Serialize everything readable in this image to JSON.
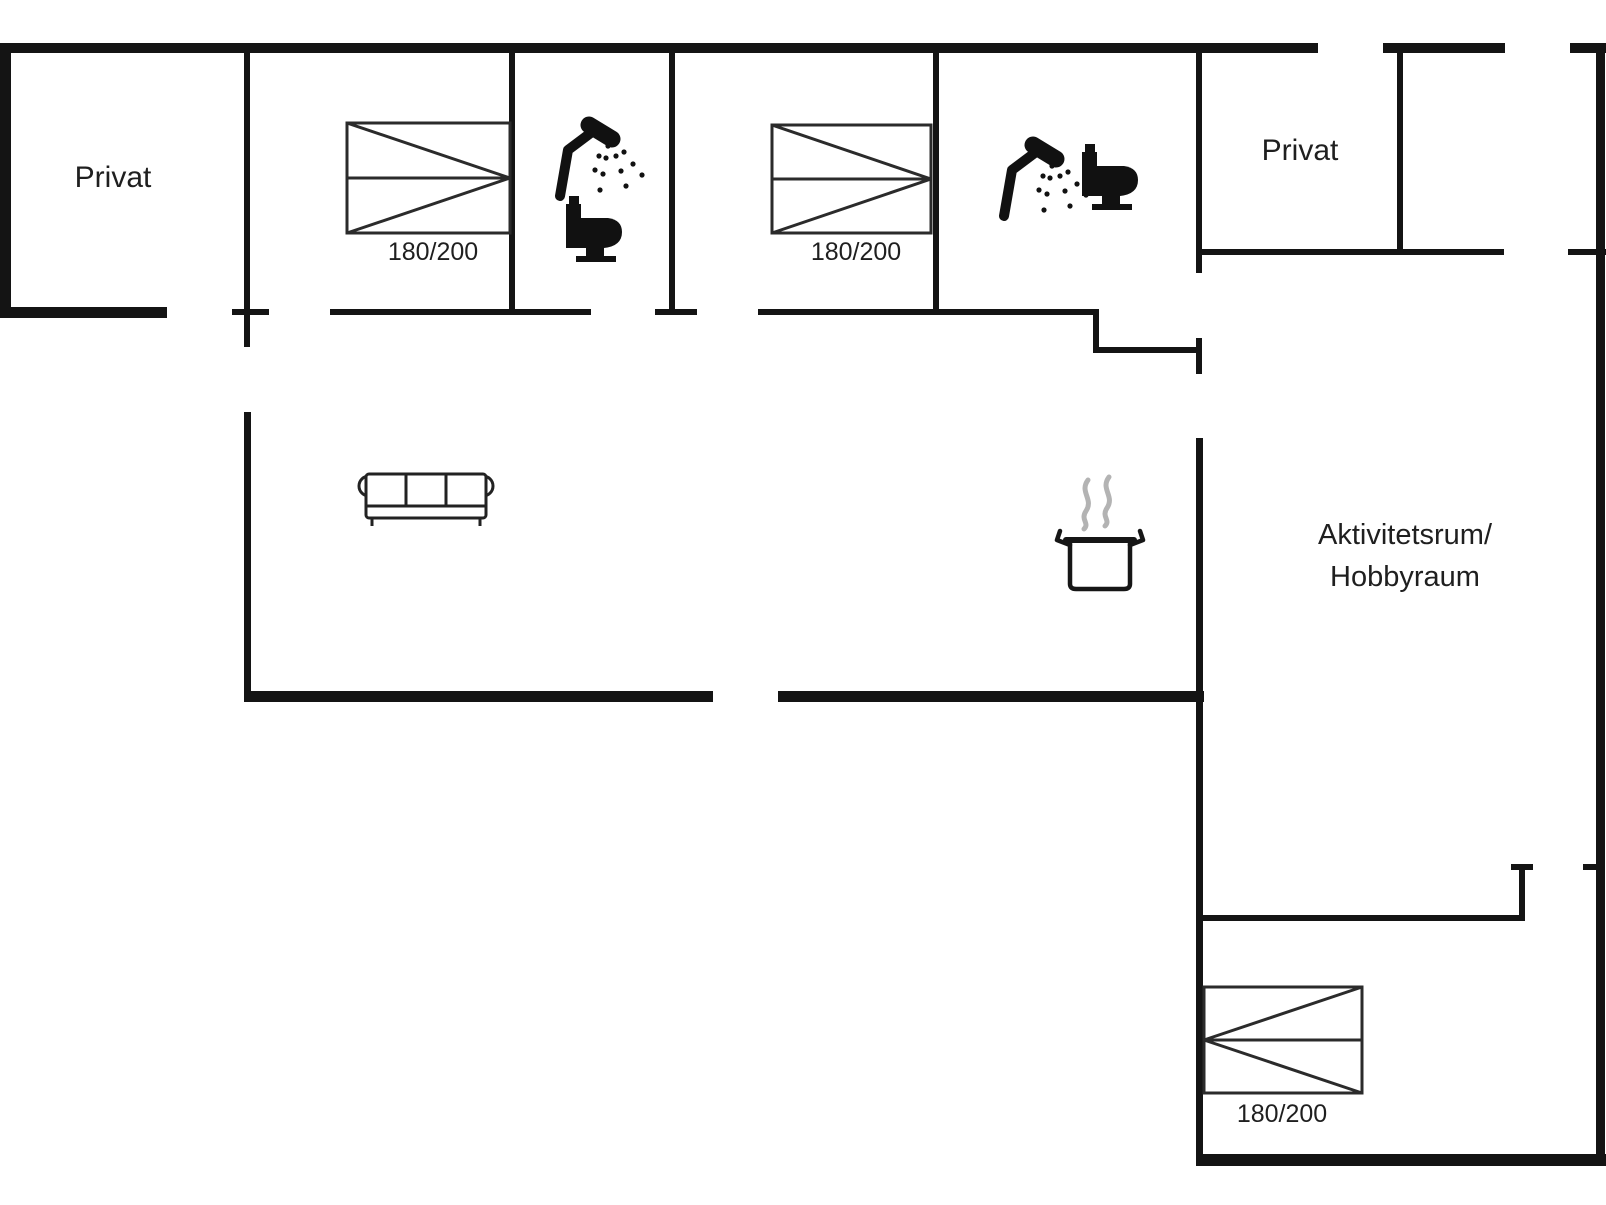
{
  "title": "Floor plan",
  "labels": {
    "privat_left": "Privat",
    "privat_right": "Privat",
    "activity_line1": "Aktivitetsrum/",
    "activity_line2": "Hobbyraum",
    "bed1_size": "180/200",
    "bed2_size": "180/200",
    "bed3_size": "180/200"
  },
  "colors": {
    "background": "#ffffff",
    "wall": "#141414",
    "furniture_line": "#222222",
    "steam": "#b3b3b3",
    "text": "#1f1f1f"
  },
  "floorplan": {
    "canvas": {
      "width": 1606,
      "height": 1205
    },
    "walls": [
      {
        "name": "top-wall-main",
        "x": 0,
        "y": 43,
        "w": 1318,
        "h": 10
      },
      {
        "name": "top-wall-seg2",
        "x": 1383,
        "y": 43,
        "w": 122,
        "h": 10
      },
      {
        "name": "top-wall-seg3",
        "x": 1570,
        "y": 43,
        "w": 36,
        "h": 10
      },
      {
        "name": "left-outer-wall",
        "x": 0,
        "y": 43,
        "w": 11,
        "h": 275
      },
      {
        "name": "privat-left-bottom-wall",
        "x": 0,
        "y": 307,
        "w": 167,
        "h": 11
      },
      {
        "name": "living-bottom-wall-left",
        "x": 244,
        "y": 691,
        "w": 469,
        "h": 11
      },
      {
        "name": "living-bottom-wall-right",
        "x": 778,
        "y": 691,
        "w": 426,
        "h": 11
      },
      {
        "name": "wing-bottom-wall",
        "x": 1196,
        "y": 1154,
        "w": 410,
        "h": 12
      },
      {
        "name": "right-outer-wall",
        "x": 1596,
        "y": 47,
        "w": 9,
        "h": 1113
      },
      {
        "name": "divider-privat1-bed1",
        "x": 244,
        "y": 43,
        "w": 6,
        "h": 304
      },
      {
        "name": "door-cap-247",
        "x": 232,
        "y": 309,
        "w": 37,
        "h": 6
      },
      {
        "name": "band-bottom-seg1",
        "x": 330,
        "y": 309,
        "w": 261,
        "h": 6
      },
      {
        "name": "divider-bed1-bath1",
        "x": 509,
        "y": 43,
        "w": 6,
        "h": 272
      },
      {
        "name": "divider-bath1-bed2",
        "x": 669,
        "y": 43,
        "w": 6,
        "h": 272
      },
      {
        "name": "door-cap-672",
        "x": 655,
        "y": 309,
        "w": 42,
        "h": 6
      },
      {
        "name": "band-bottom-seg2",
        "x": 758,
        "y": 309,
        "w": 340,
        "h": 6
      },
      {
        "name": "divider-bed2-bath2",
        "x": 933,
        "y": 43,
        "w": 6,
        "h": 272
      },
      {
        "name": "step-wall-vertical",
        "x": 1093,
        "y": 309,
        "w": 6,
        "h": 43
      },
      {
        "name": "step-wall-horizontal",
        "x": 1093,
        "y": 347,
        "w": 107,
        "h": 6
      },
      {
        "name": "door-cap-1198",
        "x": 1196,
        "y": 338,
        "w": 6,
        "h": 36
      },
      {
        "name": "privat-right-left-wall",
        "x": 1196,
        "y": 43,
        "w": 6,
        "h": 230
      },
      {
        "name": "activity-left-wall",
        "x": 1196,
        "y": 438,
        "w": 7,
        "h": 722
      },
      {
        "name": "privat-right-bottom-wall",
        "x": 1196,
        "y": 249,
        "w": 308,
        "h": 6
      },
      {
        "name": "privat-right-bottom-tick",
        "x": 1568,
        "y": 249,
        "w": 38,
        "h": 6
      },
      {
        "name": "divider-privat2-corner",
        "x": 1397,
        "y": 47,
        "w": 6,
        "h": 206
      },
      {
        "name": "niche-wall-horizontal",
        "x": 1200,
        "y": 915,
        "w": 325,
        "h": 6
      },
      {
        "name": "niche-wall-vertical",
        "x": 1519,
        "y": 867,
        "w": 6,
        "h": 54
      },
      {
        "name": "niche-wall-cap",
        "x": 1511,
        "y": 864,
        "w": 22,
        "h": 6
      },
      {
        "name": "right-wall-door-tick",
        "x": 1583,
        "y": 864,
        "w": 14,
        "h": 6
      },
      {
        "name": "living-left-wall",
        "x": 244,
        "y": 412,
        "w": 7,
        "h": 290
      }
    ]
  }
}
